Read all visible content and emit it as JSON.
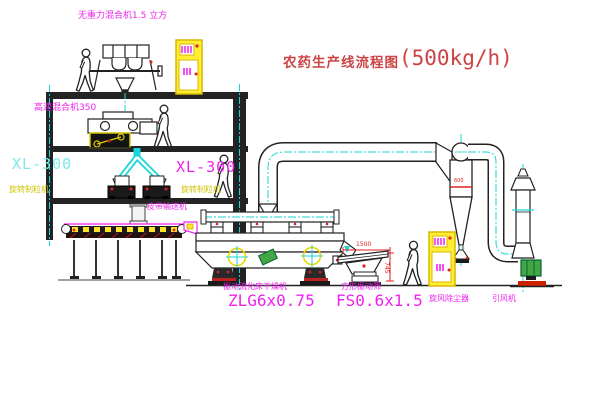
{
  "title": {
    "cn": "农药生产线流程图",
    "capacity": "(500kg/h)"
  },
  "labels": {
    "gravity_mixer": "无重力混合机1.5 立方",
    "high_speed_mixer": "高速混合机350",
    "xl300_left": "XL-300",
    "granulator_left": "旋转制粒机",
    "xl300_right": "XL-300",
    "granulator_right": "旋转制粒机",
    "belt_conveyor": "皮带输送机",
    "dryer_name": "振动流化床干燥机",
    "dryer_model": "ZLG6x0.75",
    "sieve_name": "方形振动筛",
    "sieve_model": "FS0.6x1.5",
    "cyclone": "旋风除尘器",
    "fan": "引风机"
  },
  "annotations": {
    "cyclone_size": "600",
    "dim_width": "1500",
    "dim_height": "745"
  },
  "colors": {
    "title_red": "#cc4444",
    "label_magenta": "#ee22ee",
    "label_yellow": "#cfc400",
    "label_cyan": "#7fe8e8",
    "pipe_cyan": "#19d6d6",
    "cabinet_yellow": "#ffee33",
    "fan_green": "#44a544",
    "dim_red": "#dd2222"
  }
}
